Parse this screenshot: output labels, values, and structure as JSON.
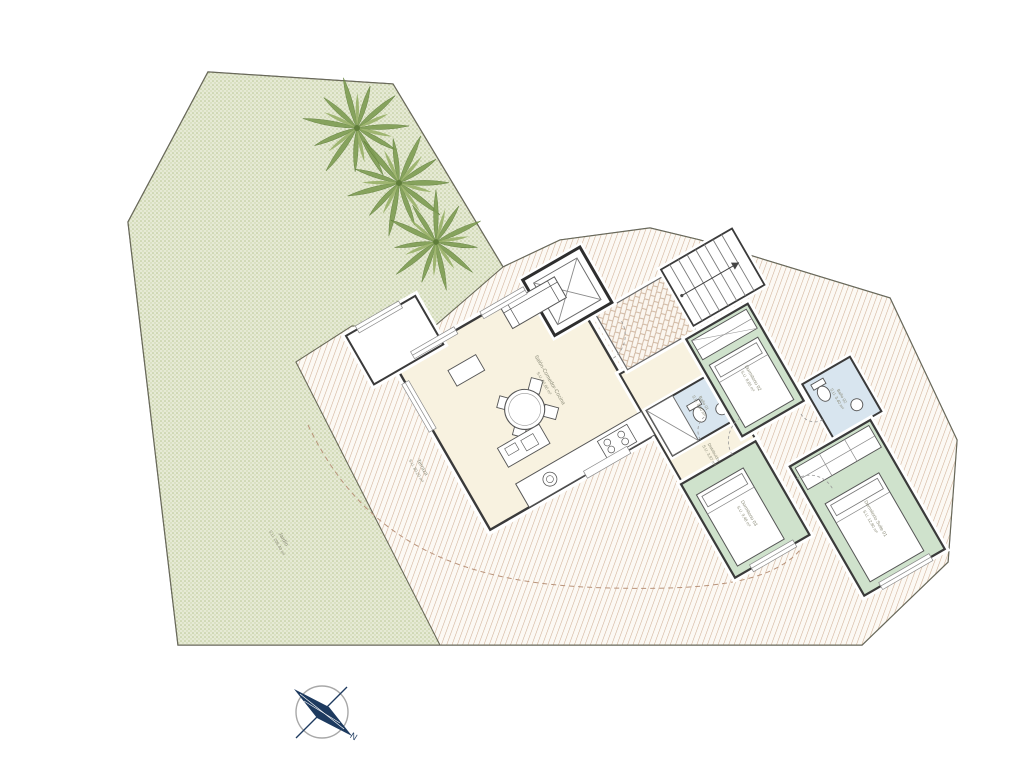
{
  "plan": {
    "title": "Apartment floor plan with garden and terrace",
    "rooms": {
      "living": {
        "name": "Salón-Comedor-Cocina",
        "area": "S.U. 30,80 m²"
      },
      "hall": {
        "name": "Distribuidor",
        "area": "S.U. 3,97 m²"
      },
      "bedroom2": {
        "name": "Dormitorio 02",
        "area": "S.U. 8,85 m²"
      },
      "bedroom3": {
        "name": "Dormitorio 03",
        "area": "S.U. 9,48 m²"
      },
      "suite": {
        "name": "Dormitorio Suite 01",
        "area": "S.U. 12,80 m²"
      },
      "bath1": {
        "name": "Baño 01",
        "area": "S.U. 3,60 m²"
      },
      "bath2": {
        "name": "Baño 02",
        "area": "S.U. 3,40 m²"
      },
      "terrace": {
        "name": "Terraza",
        "area": "S.U. 80,20 m²"
      },
      "garden": {
        "name": "Jardín",
        "area": "S.U. 206,40 m²"
      }
    },
    "compass": {
      "north_label": "N"
    },
    "colors": {
      "garden_fill": "#e6ead5",
      "garden_dot": "#b8c693",
      "terrace_hatch": "#d0b096",
      "living_fill": "#f8f2e0",
      "bedroom_fill": "#cfe2cc",
      "bath_fill": "#d8e5ef",
      "wall": "#3a3a3a",
      "compass_navy": "#1d3a5f"
    }
  }
}
